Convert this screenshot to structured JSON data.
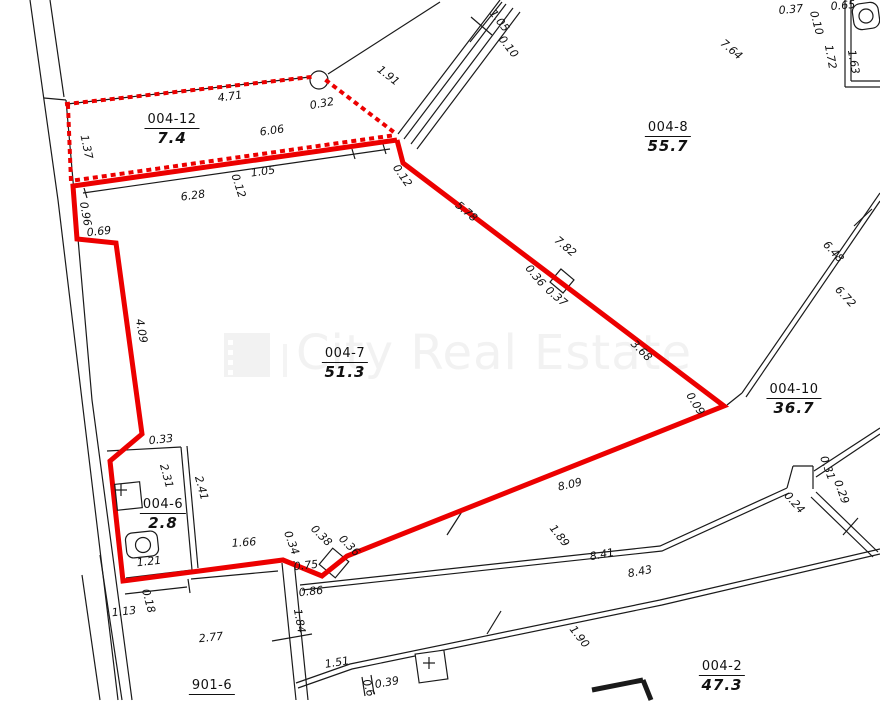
{
  "watermark": {
    "text": "City Real Estate"
  },
  "colors": {
    "boundary_red": "#ec0000",
    "line_black": "#1a1a1a",
    "watermark_gray": "#f2f2f2"
  },
  "rooms": [
    {
      "id": "004-12",
      "area": "7.4",
      "x": 172,
      "y": 108
    },
    {
      "id": "004-8",
      "area": "55.7",
      "x": 668,
      "y": 116
    },
    {
      "id": "004-7",
      "area": "51.3",
      "x": 345,
      "y": 342
    },
    {
      "id": "004-10",
      "area": "36.7",
      "x": 794,
      "y": 378
    },
    {
      "id": "004-6",
      "area": "2.8",
      "x": 163,
      "y": 493
    },
    {
      "id": "004-2",
      "area": "47.3",
      "x": 722,
      "y": 655
    },
    {
      "id": "901-6",
      "area": "",
      "x": 212,
      "y": 674
    }
  ],
  "dimensions": [
    {
      "t": "4.71",
      "x": 230,
      "y": 97,
      "r": -8
    },
    {
      "t": "0.32",
      "x": 322,
      "y": 104,
      "r": -10
    },
    {
      "t": "1.91",
      "x": 388,
      "y": 76,
      "r": 38
    },
    {
      "t": "1.37",
      "x": 86,
      "y": 147,
      "r": 78
    },
    {
      "t": "6.06",
      "x": 272,
      "y": 131,
      "r": -8
    },
    {
      "t": "1.05",
      "x": 263,
      "y": 172,
      "r": -8
    },
    {
      "t": "0.12",
      "x": 238,
      "y": 186,
      "r": 72
    },
    {
      "t": "6.28",
      "x": 193,
      "y": 196,
      "r": -8
    },
    {
      "t": "0.96",
      "x": 85,
      "y": 214,
      "r": 80
    },
    {
      "t": "0.69",
      "x": 99,
      "y": 232,
      "r": -6
    },
    {
      "t": "0.12",
      "x": 402,
      "y": 176,
      "r": 55
    },
    {
      "t": "1.05",
      "x": 499,
      "y": 21,
      "r": 52
    },
    {
      "t": "0.10",
      "x": 508,
      "y": 47,
      "r": 52
    },
    {
      "t": "7.64",
      "x": 731,
      "y": 50,
      "r": 40
    },
    {
      "t": "0.37",
      "x": 791,
      "y": 10,
      "r": -5
    },
    {
      "t": "0.10",
      "x": 816,
      "y": 23,
      "r": 75
    },
    {
      "t": "0.65",
      "x": 843,
      "y": 6,
      "r": -5
    },
    {
      "t": "1.72",
      "x": 830,
      "y": 57,
      "r": 80
    },
    {
      "t": "1.63",
      "x": 853,
      "y": 62,
      "r": 80
    },
    {
      "t": "6.48",
      "x": 833,
      "y": 252,
      "r": 47
    },
    {
      "t": "6.72",
      "x": 845,
      "y": 297,
      "r": 47
    },
    {
      "t": "5.78",
      "x": 466,
      "y": 212,
      "r": 40
    },
    {
      "t": "7.82",
      "x": 565,
      "y": 247,
      "r": 40
    },
    {
      "t": "0.36",
      "x": 535,
      "y": 276,
      "r": 50
    },
    {
      "t": "0.37",
      "x": 556,
      "y": 297,
      "r": 40
    },
    {
      "t": "3.68",
      "x": 641,
      "y": 351,
      "r": 45
    },
    {
      "t": "0.09",
      "x": 695,
      "y": 404,
      "r": 58
    },
    {
      "t": "4.09",
      "x": 141,
      "y": 331,
      "r": 80
    },
    {
      "t": "0.31",
      "x": 827,
      "y": 468,
      "r": 70
    },
    {
      "t": "0.29",
      "x": 841,
      "y": 492,
      "r": 70
    },
    {
      "t": "0.24",
      "x": 794,
      "y": 503,
      "r": 48
    },
    {
      "t": "8.09",
      "x": 570,
      "y": 485,
      "r": -13
    },
    {
      "t": "1.89",
      "x": 559,
      "y": 536,
      "r": 52
    },
    {
      "t": "8.41",
      "x": 602,
      "y": 555,
      "r": -11
    },
    {
      "t": "8.43",
      "x": 640,
      "y": 572,
      "r": -11
    },
    {
      "t": "1.90",
      "x": 579,
      "y": 637,
      "r": 52
    },
    {
      "t": "1.51",
      "x": 337,
      "y": 663,
      "r": -9
    },
    {
      "t": "0.39",
      "x": 387,
      "y": 683,
      "r": -10
    },
    {
      "t": "0.6",
      "x": 368,
      "y": 688,
      "r": 72
    },
    {
      "t": "0.33",
      "x": 161,
      "y": 440,
      "r": -6
    },
    {
      "t": "2.31",
      "x": 166,
      "y": 476,
      "r": 75
    },
    {
      "t": "2.41",
      "x": 201,
      "y": 488,
      "r": 75
    },
    {
      "t": "1.21",
      "x": 149,
      "y": 562,
      "r": -6
    },
    {
      "t": "1.66",
      "x": 244,
      "y": 543,
      "r": -4
    },
    {
      "t": "0.34",
      "x": 291,
      "y": 543,
      "r": 70
    },
    {
      "t": "0.38",
      "x": 321,
      "y": 536,
      "r": 45
    },
    {
      "t": "0.36",
      "x": 349,
      "y": 546,
      "r": 45
    },
    {
      "t": "0.75",
      "x": 306,
      "y": 566,
      "r": -6
    },
    {
      "t": "0.86",
      "x": 311,
      "y": 592,
      "r": -6
    },
    {
      "t": "1.84",
      "x": 299,
      "y": 621,
      "r": 80
    },
    {
      "t": "1.13",
      "x": 124,
      "y": 612,
      "r": -6
    },
    {
      "t": "0.18",
      "x": 148,
      "y": 601,
      "r": 75
    },
    {
      "t": "2.77",
      "x": 211,
      "y": 638,
      "r": -6
    }
  ],
  "geometry": {
    "black_lines": [
      [
        [
          30,
          0
        ],
        [
          58,
          200
        ],
        [
          118,
          700
        ]
      ],
      [
        [
          50,
          0
        ],
        [
          64,
          97
        ]
      ],
      [
        [
          44,
          98
        ],
        [
          66,
          100
        ]
      ],
      [
        [
          66,
          100
        ],
        [
          92,
          400
        ],
        [
          132,
          700
        ]
      ],
      [
        [
          67,
          104
        ],
        [
          310,
          77
        ]
      ],
      [
        [
          328,
          74
        ],
        [
          440,
          2
        ]
      ],
      [
        [
          75,
          186
        ],
        [
          397,
          141
        ]
      ],
      [
        [
          83,
          193
        ],
        [
          390,
          149
        ]
      ],
      [
        [
          84,
          188
        ],
        [
          87,
          198
        ]
      ],
      [
        [
          352,
          149
        ],
        [
          355,
          159
        ]
      ],
      [
        [
          383,
          144
        ],
        [
          386,
          154
        ]
      ],
      [
        [
          398,
          134
        ],
        [
          500,
          0
        ]
      ],
      [
        [
          404,
          139
        ],
        [
          506,
          4
        ]
      ],
      [
        [
          411,
          144
        ],
        [
          513,
          8
        ]
      ],
      [
        [
          417,
          149
        ],
        [
          520,
          12
        ]
      ],
      [
        [
          502,
          2
        ],
        [
          470,
          42
        ]
      ],
      [
        [
          471,
          17
        ],
        [
          492,
          35
        ]
      ],
      [
        [
          845,
          0
        ],
        [
          845,
          87
        ]
      ],
      [
        [
          851,
          0
        ],
        [
          851,
          81
        ]
      ],
      [
        [
          845,
          87
        ],
        [
          880,
          87
        ]
      ],
      [
        [
          851,
          81
        ],
        [
          880,
          81
        ]
      ],
      [
        [
          880,
          193
        ],
        [
          742,
          393
        ]
      ],
      [
        [
          880,
          201
        ],
        [
          746,
          397
        ]
      ],
      [
        [
          854,
          226
        ],
        [
          872,
          209
        ]
      ],
      [
        [
          742,
          393
        ],
        [
          727,
          405
        ]
      ],
      [
        [
          880,
          428
        ],
        [
          814,
          471
        ]
      ],
      [
        [
          880,
          434
        ],
        [
          816,
          477
        ]
      ],
      [
        [
          813,
          466
        ],
        [
          813,
          489
        ]
      ],
      [
        [
          793,
          466
        ],
        [
          813,
          466
        ]
      ],
      [
        [
          787,
          488
        ],
        [
          793,
          466
        ]
      ],
      [
        [
          816,
          492
        ],
        [
          878,
          552
        ]
      ],
      [
        [
          811,
          497
        ],
        [
          873,
          557
        ]
      ],
      [
        [
          843,
          535
        ],
        [
          858,
          518
        ]
      ],
      [
        [
          300,
          585
        ],
        [
          660,
          546
        ],
        [
          787,
          488
        ]
      ],
      [
        [
          302,
          590
        ],
        [
          662,
          551
        ],
        [
          789,
          493
        ]
      ],
      [
        [
          447,
          535
        ],
        [
          463,
          510
        ]
      ],
      [
        [
          296,
          683
        ],
        [
          350,
          664
        ],
        [
          660,
          600
        ],
        [
          880,
          549
        ]
      ],
      [
        [
          298,
          688
        ],
        [
          352,
          669
        ],
        [
          662,
          605
        ],
        [
          880,
          554
        ]
      ],
      [
        [
          487,
          634
        ],
        [
          501,
          611
        ]
      ],
      [
        [
          362,
          677
        ],
        [
          365,
          696
        ]
      ],
      [
        [
          371,
          675
        ],
        [
          374,
          694
        ]
      ],
      [
        [
          107,
          451
        ],
        [
          181,
          447
        ]
      ],
      [
        [
          181,
          447
        ],
        [
          192,
          570
        ]
      ],
      [
        [
          187,
          446
        ],
        [
          198,
          568
        ]
      ],
      [
        [
          192,
          570
        ],
        [
          126,
          578
        ]
      ],
      [
        [
          125,
          594
        ],
        [
          187,
          587
        ]
      ],
      [
        [
          188,
          579
        ],
        [
          190,
          593
        ]
      ],
      [
        [
          191,
          579
        ],
        [
          278,
          571
        ]
      ],
      [
        [
          282,
          563
        ],
        [
          296,
          700
        ]
      ],
      [
        [
          294,
          561
        ],
        [
          308,
          700
        ]
      ],
      [
        [
          272,
          641
        ],
        [
          312,
          634
        ]
      ],
      [
        [
          100,
          555
        ],
        [
          122,
          700
        ]
      ],
      [
        [
          82,
          575
        ],
        [
          100,
          700
        ]
      ]
    ],
    "thick_black_lines": [
      [
        [
          592,
          690
        ],
        [
          643,
          680
        ]
      ],
      [
        [
          643,
          680
        ],
        [
          651,
          700
        ]
      ]
    ],
    "red_solid": [
      [
        [
          397,
          140
        ],
        [
          403,
          163
        ],
        [
          724,
          406
        ],
        [
          347,
          556
        ],
        [
          322,
          576
        ],
        [
          283,
          560
        ],
        [
          123,
          581
        ],
        [
          110,
          461
        ],
        [
          142,
          434
        ],
        [
          116,
          243
        ],
        [
          77,
          239
        ],
        [
          73,
          186
        ],
        [
          397,
          140
        ]
      ]
    ],
    "red_dotted": [
      [
        [
          67,
          104
        ],
        [
          311,
          77
        ]
      ],
      [
        [
          327,
          81
        ],
        [
          395,
          133
        ]
      ],
      [
        [
          68,
          106
        ],
        [
          71,
          181
        ]
      ],
      [
        [
          77,
          180
        ],
        [
          396,
          135
        ]
      ]
    ],
    "circles": [
      {
        "cx": 319,
        "cy": 80,
        "r": 9
      }
    ],
    "jog_squares": [
      {
        "cx": 562,
        "cy": 281,
        "s": 17,
        "r": 40
      },
      {
        "cx": 334,
        "cy": 563,
        "s": 21,
        "r": 40
      }
    ],
    "fixtures": {
      "sink": {
        "x": 116,
        "y": 483,
        "w": 25,
        "h": 26,
        "rot": -6,
        "plus": [
          121,
          490
        ]
      },
      "toilet_main": {
        "x": 126,
        "y": 532,
        "w": 32,
        "h": 25,
        "rx": 7,
        "rot": -6,
        "circle": [
          143,
          545,
          7.5
        ]
      },
      "toilet_top": {
        "x": 853,
        "y": 3,
        "w": 26,
        "h": 26,
        "rx": 8,
        "rot": -8,
        "circle": [
          866,
          16,
          7
        ]
      },
      "marker_square": {
        "x": 417,
        "y": 652,
        "w": 29,
        "h": 29,
        "rot": -8,
        "plus": [
          429,
          663
        ]
      }
    }
  }
}
